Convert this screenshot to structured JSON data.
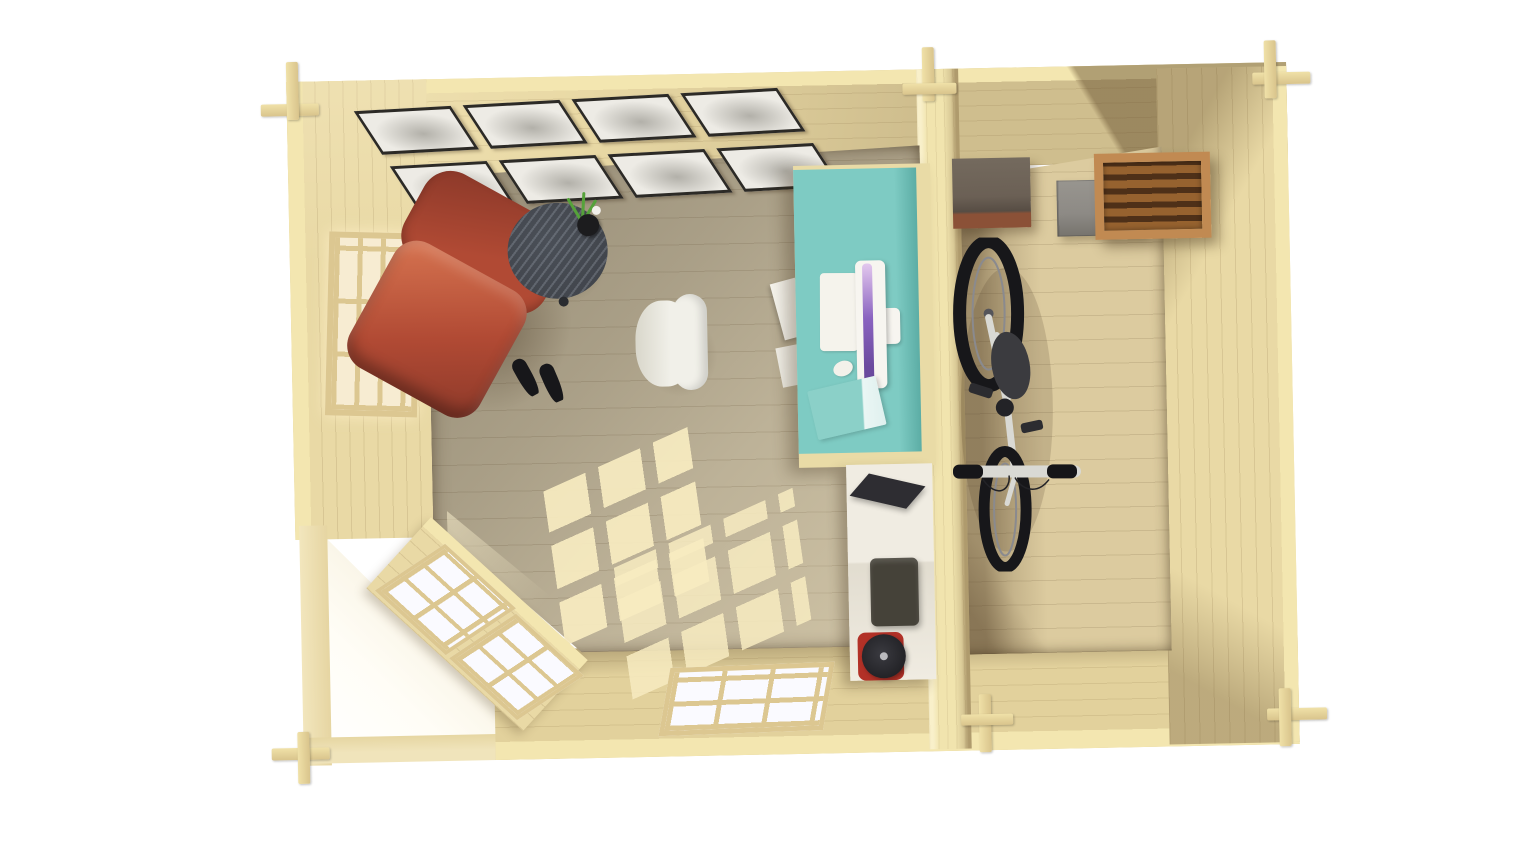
{
  "scene": {
    "title": "Log cabin garden office - top-down interior 3D view",
    "rooms": [
      {
        "id": "office",
        "label": "home office room"
      },
      {
        "id": "storage",
        "label": "storage room"
      }
    ],
    "gallery": {
      "pictures": 8,
      "rows": 2,
      "cols": 4
    },
    "left_window": {
      "cols": 3,
      "rows": 3
    },
    "bottom_window": {
      "cols": 3,
      "rows": 2
    },
    "corner_door": {
      "glazed_units": 2,
      "cols_per_unit": 2,
      "rows_per_unit": 3
    },
    "objects": [
      "picture-gallery",
      "terracotta-armchair",
      "black-heels",
      "round-side-table",
      "plant-in-vase",
      "white-office-chair",
      "turquoise-desk",
      "monitor",
      "keyboard",
      "mouse",
      "turquoise-book",
      "white-boxes",
      "white-cabinet",
      "laptop",
      "printer",
      "red-kettle",
      "bicycle",
      "rustic-wooden-box",
      "gray-box",
      "slatted-wooden-crate"
    ]
  },
  "colors": {
    "bg": "#ffffff",
    "wallTop": "#f3e6b0",
    "wallFace": "#e9d9a5",
    "partitionFace": "#f1e4ae",
    "floorOffice": "#bdb298",
    "floorStorage": "#dccb9f",
    "sunlight": "#f8ecc1",
    "paneWarm": "#f7ecd2",
    "paneWhite": "#fafaff",
    "winFrame": "#dcc791",
    "pictureFrame": "#2c2a26",
    "picturePaper": "#edebe5",
    "armchair": "#b14a34",
    "armchairDark": "#8a3829",
    "armchairLight": "#d26f4d",
    "sideTable": "#42464d",
    "plant": "#55a23a",
    "vase": "#1c1c1e",
    "chairWhite": "#f1f0e9",
    "chairWhiteShade": "#d9d7cb",
    "desk": "#7ecbc3",
    "deskShade": "#5cada5",
    "deskWood": "#e9dba6",
    "keyboard": "#f5f3ec",
    "monitorBody": "#f7f5f0",
    "screenA": "#8a63c0",
    "screenB": "#e3c8ee",
    "mouse": "#f3f1ea",
    "book": "#8bd0c8",
    "cabinet": "#f0ece2",
    "laptop": "#2e2d32",
    "printer": "#454239",
    "kettleRed": "#b23127",
    "kettleBlack": "#232327",
    "bikeFrame": "#d9d9d4",
    "bikeTire": "#17171a",
    "bikeSaddle": "#3b3b3f",
    "crateFrame": "#c18a52",
    "crateSlat": "#96622f",
    "crateSlatDark": "#4e3018",
    "grayBox": "#8d8a85",
    "rusticBox": "#6b6055",
    "rusticBase": "#8b5137"
  }
}
